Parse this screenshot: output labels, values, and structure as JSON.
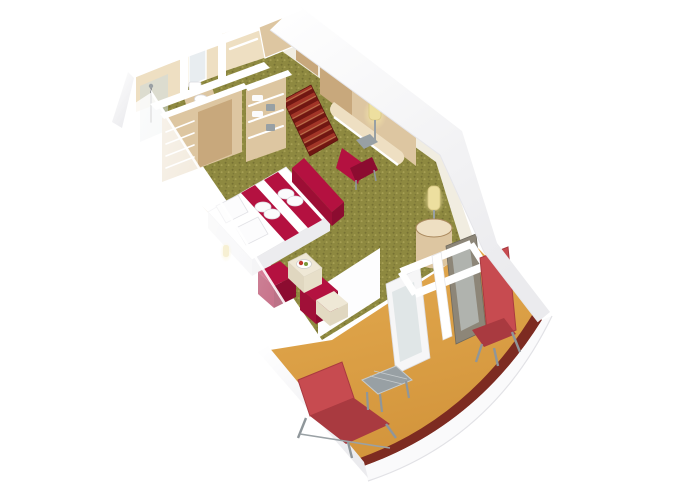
{
  "scene": {
    "type": "3d-cutaway-cabin-render",
    "areas": [
      "shower-room",
      "toilet-room",
      "bathroom",
      "wardrobe",
      "entrance-corridor",
      "bedroom",
      "sitting-area",
      "desk-area",
      "balcony"
    ]
  },
  "palette": {
    "background": "#ffffff",
    "carpet_base": "#8e8940",
    "carpet_dark": "#6e692f",
    "carpet_light": "#aaa457",
    "balcony_floor": "#e4ab50",
    "balcony_floor_dark": "#d3953c",
    "parapet_cap": "#7d2b21",
    "rug_base": "#a23527",
    "rug_stripe": "#701712",
    "furniture_red": "#b41140",
    "furniture_red_dark": "#8c0c30",
    "lounger_red": "#c74b50",
    "lounger_red_dark": "#a93a40",
    "wood_light": "#eedfc2",
    "wood_mid": "#ddc6a1",
    "wood_dark": "#c8a87c",
    "wood_edge": "#ab8a5f",
    "wall_white": "#ffffff",
    "wall_shade": "#ebebee",
    "wall_cream": "#f1ede1",
    "glass": "rgba(205,216,218,0.55)",
    "glass_frame": "#8d8678",
    "metal_gray": "#98a0a4",
    "lamp_glow": "#f6e7a8",
    "lamp_shade": "#eddf9f",
    "cream_furniture": "#efe8d6",
    "cream_furniture_dark": "#e0d7c0",
    "towel_white": "#fbfbfc",
    "ghost_strong": "rgba(255,255,255,0.88)",
    "ghost_weak": "rgba(246,247,249,0.42)",
    "hull_line": "#e2e2e6",
    "hull_white": "#fafafb"
  }
}
